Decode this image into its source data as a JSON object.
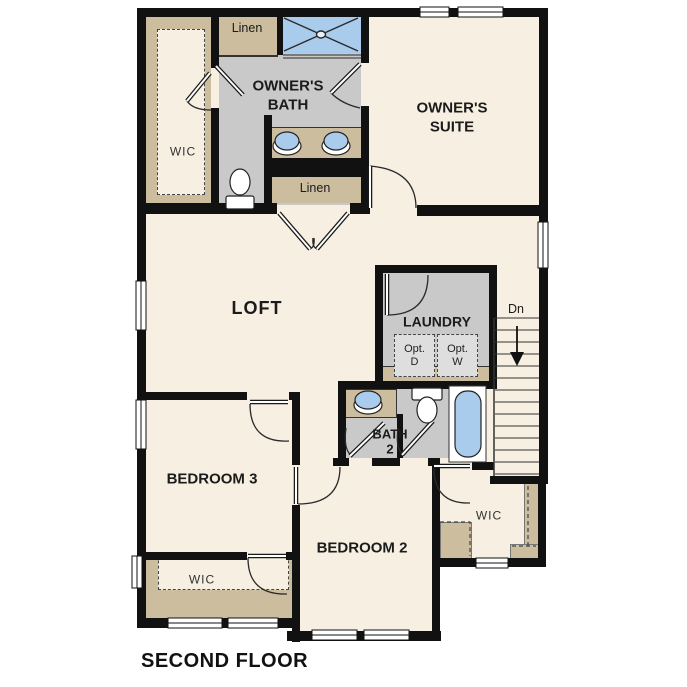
{
  "floor_plan": {
    "title": "SECOND FLOOR",
    "labels": {
      "owners_bath": "OWNER'S\nBATH",
      "owners_suite": "OWNER'S\nSUITE",
      "loft": "LOFT",
      "laundry": "LAUNDRY",
      "bedroom3": "BEDROOM 3",
      "bedroom2": "BEDROOM 2",
      "bath2": "BATH\n2",
      "wic_owner": "WIC",
      "wic_bed3": "WIC",
      "wic_bed2": "WIC",
      "linen_upper": "Linen",
      "linen_lower": "Linen",
      "opt_dryer": "Opt.\nD",
      "opt_washer": "Opt.\nW",
      "stairs_down": "Dn"
    },
    "fixtures": [
      "shower",
      "vanity-sink",
      "vanity-sink",
      "toilet",
      "linen-closet",
      "linen-closet",
      "washer-optional",
      "dryer-optional",
      "sink",
      "toilet",
      "bathtub",
      "stairs-down-arrow"
    ],
    "colors": {
      "wall": "#111111",
      "floor": "#f6efe2",
      "tile_floor": "#c9c9c9",
      "closet_shelving": "#ccbd9e",
      "fixture_blue": "#a9cbec",
      "opt_box": "#dedede"
    }
  }
}
